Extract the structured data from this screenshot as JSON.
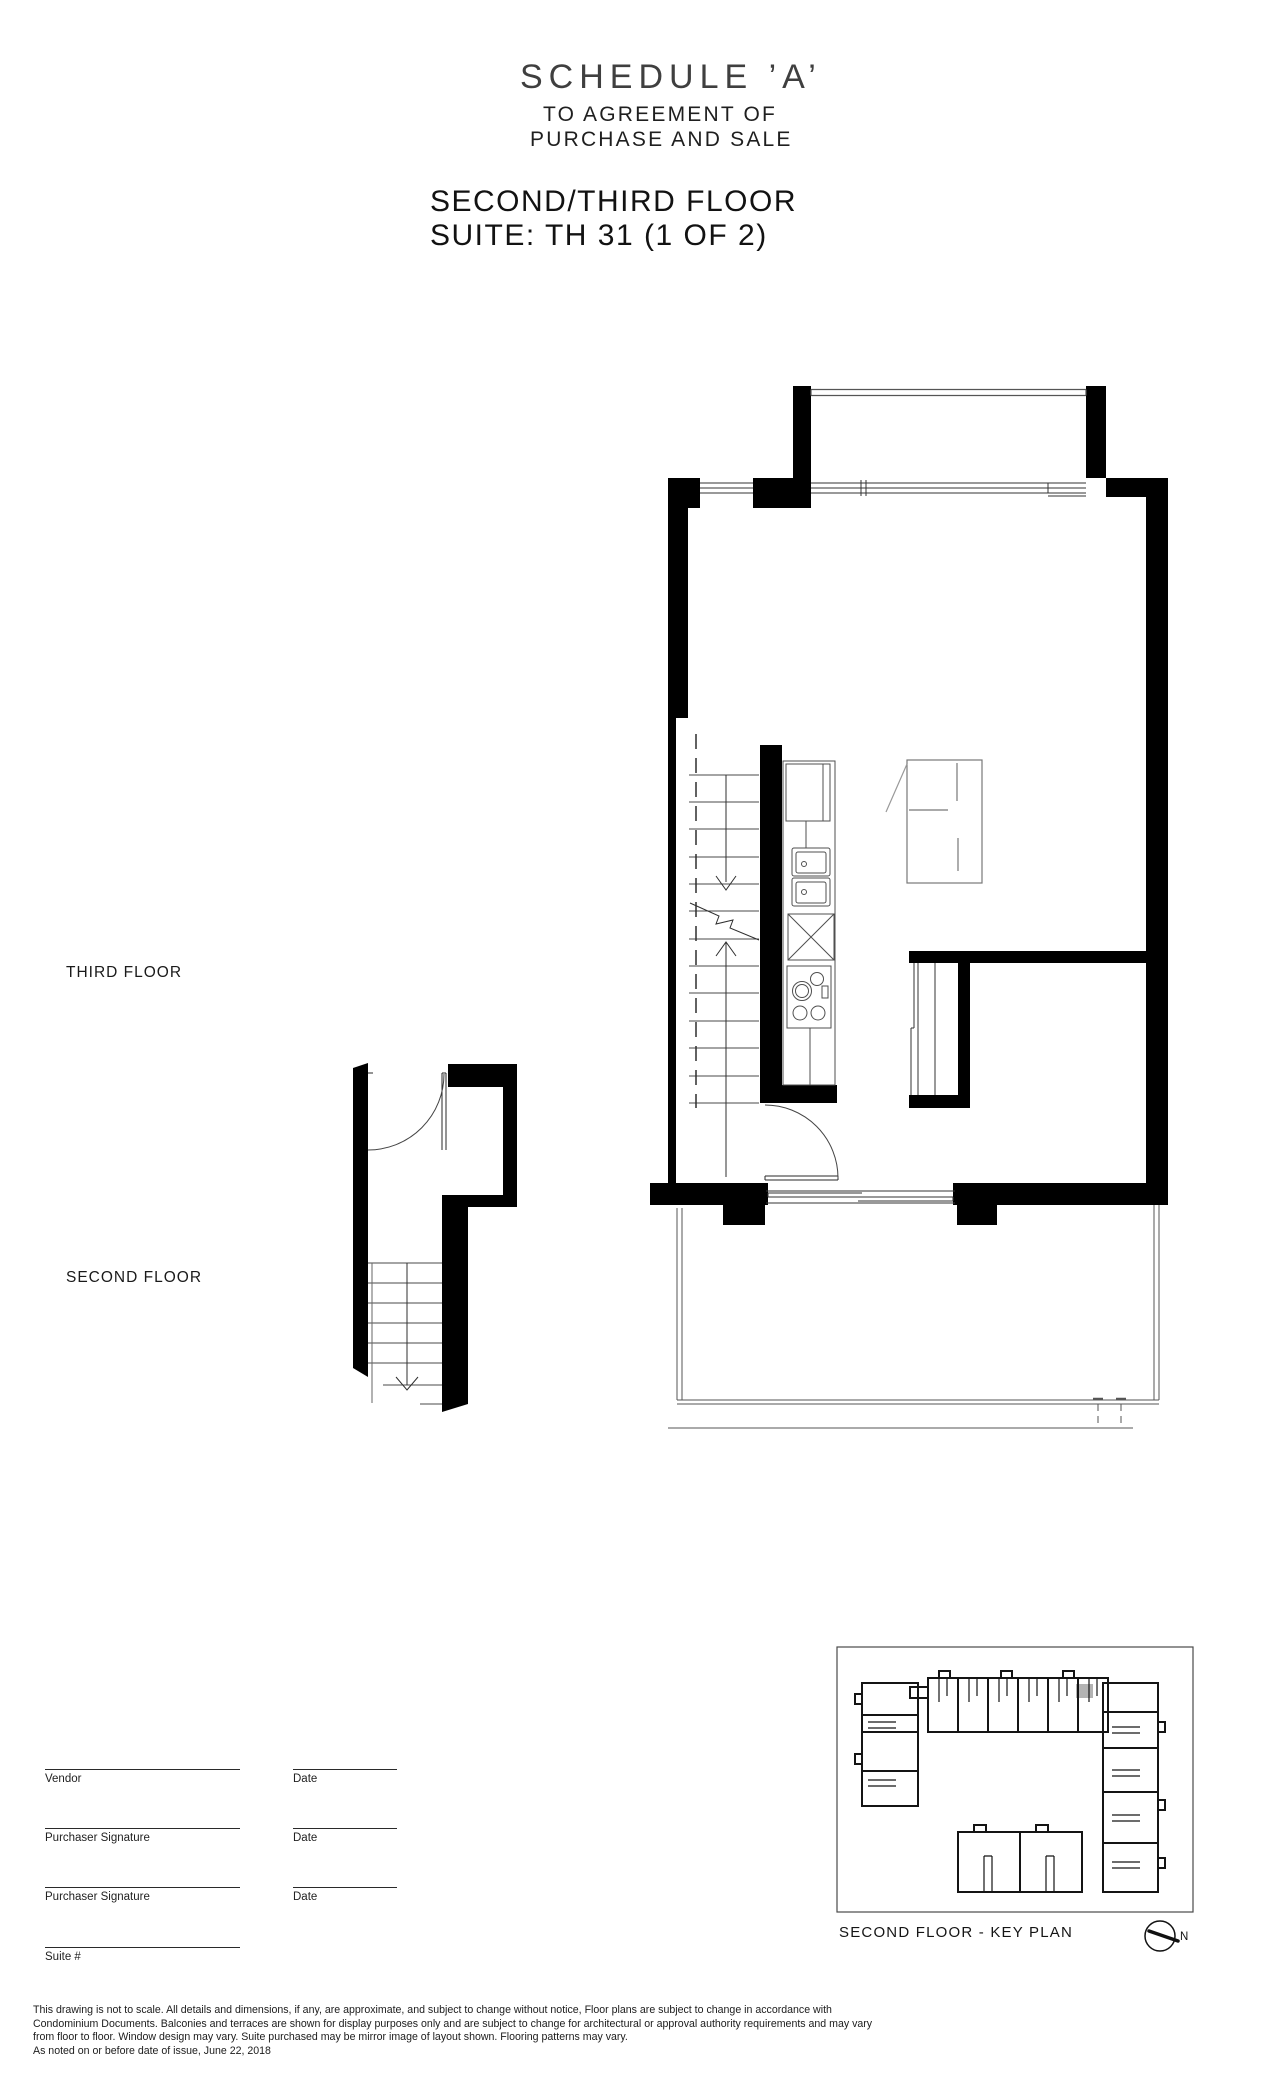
{
  "header": {
    "schedule_title": "SCHEDULE ’A’",
    "agreement_line1": "TO AGREEMENT OF",
    "agreement_line2": "PURCHASE AND SALE",
    "floor_title": "SECOND/THIRD FLOOR",
    "suite_title": "SUITE: TH 31 (1 OF 2)"
  },
  "plan_labels": {
    "third_floor": "THIRD FLOOR",
    "second_floor": "SECOND FLOOR"
  },
  "signature_block": {
    "rows": [
      {
        "label": "Vendor",
        "date_label": "Date"
      },
      {
        "label": "Purchaser Signature",
        "date_label": "Date"
      },
      {
        "label": "Purchaser Signature",
        "date_label": "Date"
      }
    ],
    "suite_label": "Suite #"
  },
  "key_plan": {
    "caption": "SECOND FLOOR - KEY PLAN",
    "north_label": "N",
    "highlight_color": "#b3b3b3"
  },
  "disclaimer": {
    "line1": "This drawing is not to scale. All details and dimensions, if any, are approximate, and subject to change without notice, Floor plans are subject to change in accordance with",
    "line2": "Condominium Documents. Balconies and terraces are shown for display purposes only and are subject to change for architectural or approval authority requirements and may vary",
    "line3": "from floor to floor. Window design may vary. Suite purchased may be mirror image of layout shown. Flooring patterns may vary.",
    "line4": "As noted on or before date of issue, June 22, 2018"
  }
}
